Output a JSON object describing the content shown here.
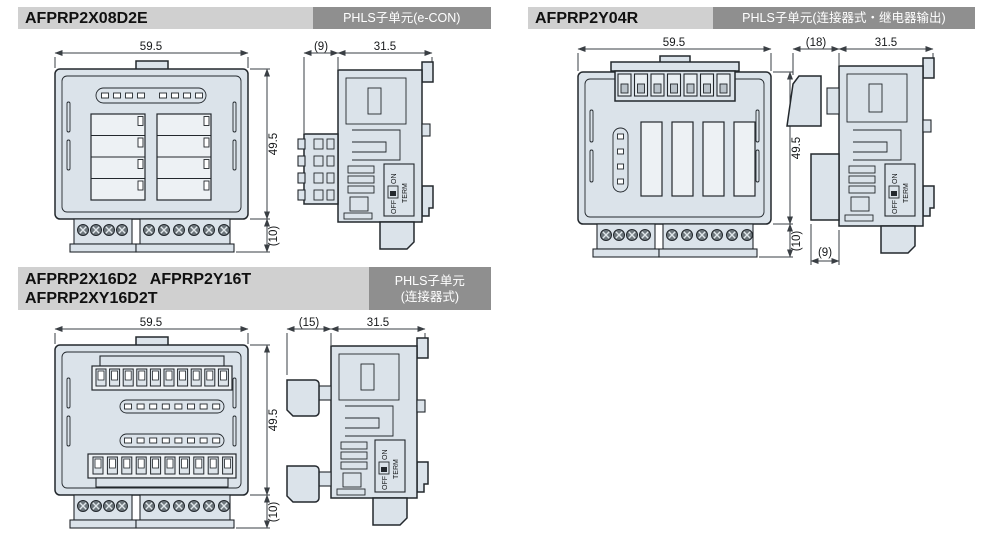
{
  "colors": {
    "header_bg": "#d0d0d0",
    "badge_bg": "#8f8f8f",
    "badge_text": "#ffffff",
    "module_fill": "#dbe3ea",
    "outline": "#23282d"
  },
  "switch": {
    "off": "OFF",
    "on": "ON",
    "term": "TERM"
  },
  "sections": [
    {
      "title": "AFPRP2X08D2E",
      "badge": "PHLS子单元(e-CON)",
      "front": {
        "dim_width": "59.5",
        "dim_height": "49.5",
        "dim_bottom": "(10)"
      },
      "side": {
        "dim_left": "(9)",
        "dim_width": "31.5"
      }
    },
    {
      "title": "AFPRP2Y04R",
      "badge": "PHLS子单元(连接器式・继电器输出)",
      "front": {
        "dim_width": "59.5",
        "dim_height": "49.5",
        "dim_bottom": "(10)"
      },
      "side": {
        "dim_left": "(18)",
        "dim_width": "31.5",
        "dim_bottom": "(9)"
      }
    },
    {
      "title_line1": "AFPRP2X16D2   AFPRP2Y16T",
      "title_line2": "AFPRP2XY16D2T",
      "badge_line1": "PHLS子单元",
      "badge_line2": "(连接器式)",
      "front": {
        "dim_width": "59.5",
        "dim_height": "49.5",
        "dim_bottom": "(10)"
      },
      "side": {
        "dim_left": "(15)",
        "dim_width": "31.5"
      }
    }
  ]
}
